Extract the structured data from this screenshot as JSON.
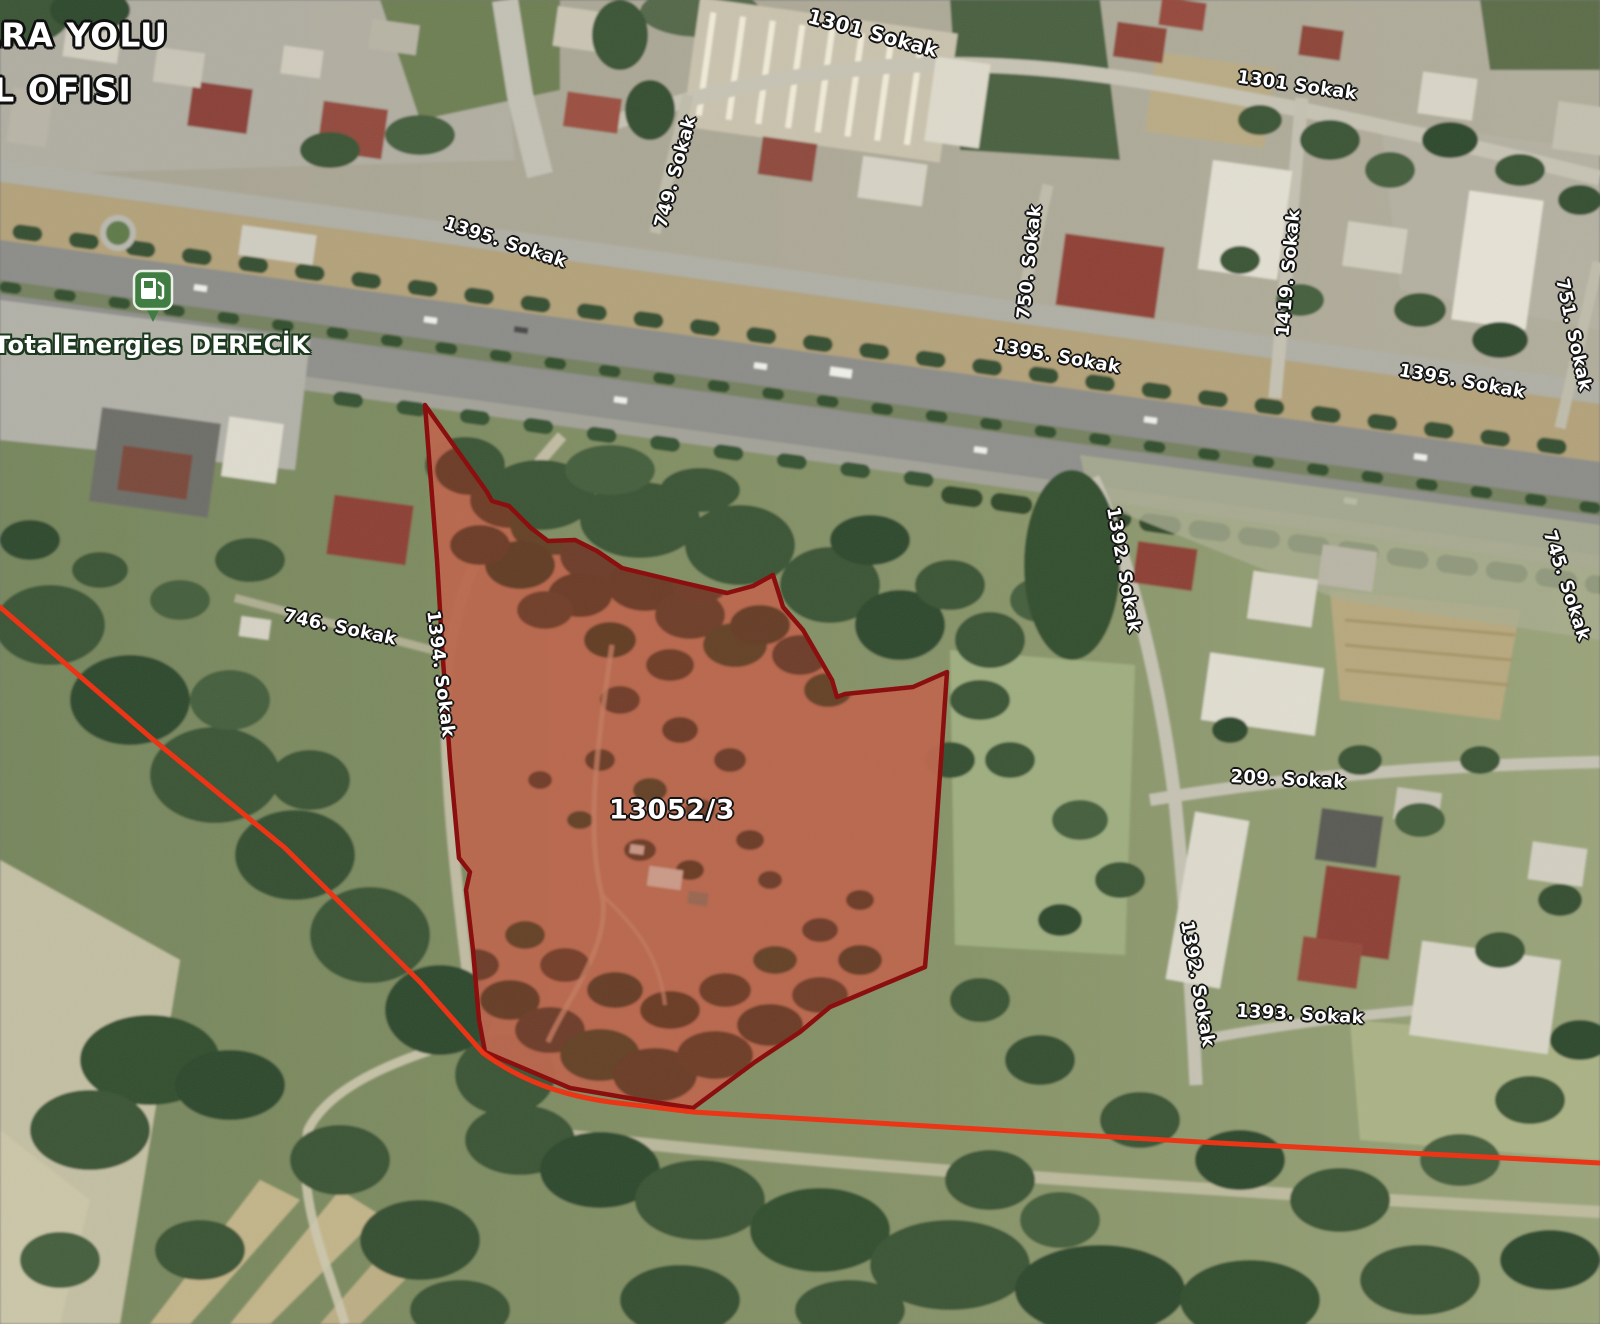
{
  "map_overlay": {
    "corner_text": {
      "line1": "KARA YOLU",
      "line2": "OL OFISI"
    },
    "poi": {
      "name": "TotalEnergies DERECİK",
      "icon": "fuel-station-icon",
      "pin_color": "#3f7d43"
    },
    "parcel": {
      "number": "13052/3",
      "outline_color": "#8c0f0f",
      "fill_tint": "rgba(190,30,20,0.24)"
    },
    "boundary_line_color": "#ea3517",
    "streets": [
      {
        "name": "1301 Sokak"
      },
      {
        "name": "1301 Sokak"
      },
      {
        "name": "1395. Sokak"
      },
      {
        "name": "1395. Sokak"
      },
      {
        "name": "1395. Sokak"
      },
      {
        "name": "749. Sokak"
      },
      {
        "name": "750. Sokak"
      },
      {
        "name": "1419. Sokak"
      },
      {
        "name": "751. Sokak"
      },
      {
        "name": "746. Sokak"
      },
      {
        "name": "1394. Sokak"
      },
      {
        "name": "1392. Sokak"
      },
      {
        "name": "1392. Sokak"
      },
      {
        "name": "209. Sokak"
      },
      {
        "name": "1393. Sokak"
      },
      {
        "name": "745. Sokak"
      }
    ]
  }
}
